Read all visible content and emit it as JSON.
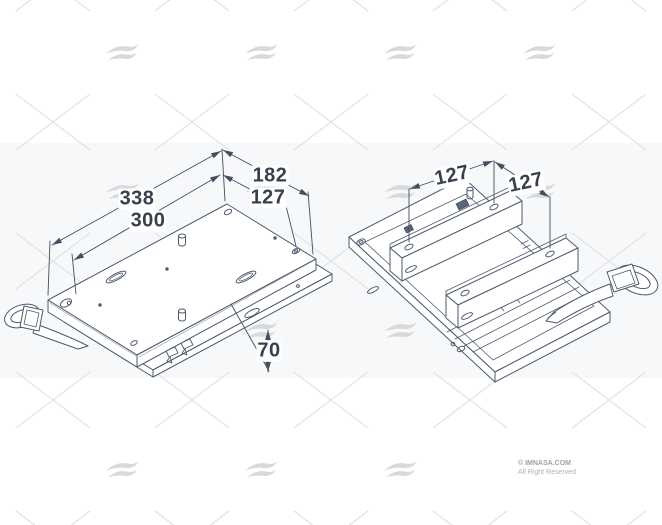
{
  "watermark": {
    "logo": "imnasa-wave-logo"
  },
  "views": {
    "left": {
      "name": "base plate bottom isometric view",
      "dims": {
        "d338": "338",
        "d300": "300",
        "d182": "182",
        "d127": "127",
        "d70": "70"
      }
    },
    "right": {
      "name": "slide base top isometric view",
      "dims": {
        "d127a": "127",
        "d127b": "127"
      }
    }
  },
  "footer": {
    "copyright": "© IMNASA.COM",
    "rights": "All Right Reserved"
  }
}
